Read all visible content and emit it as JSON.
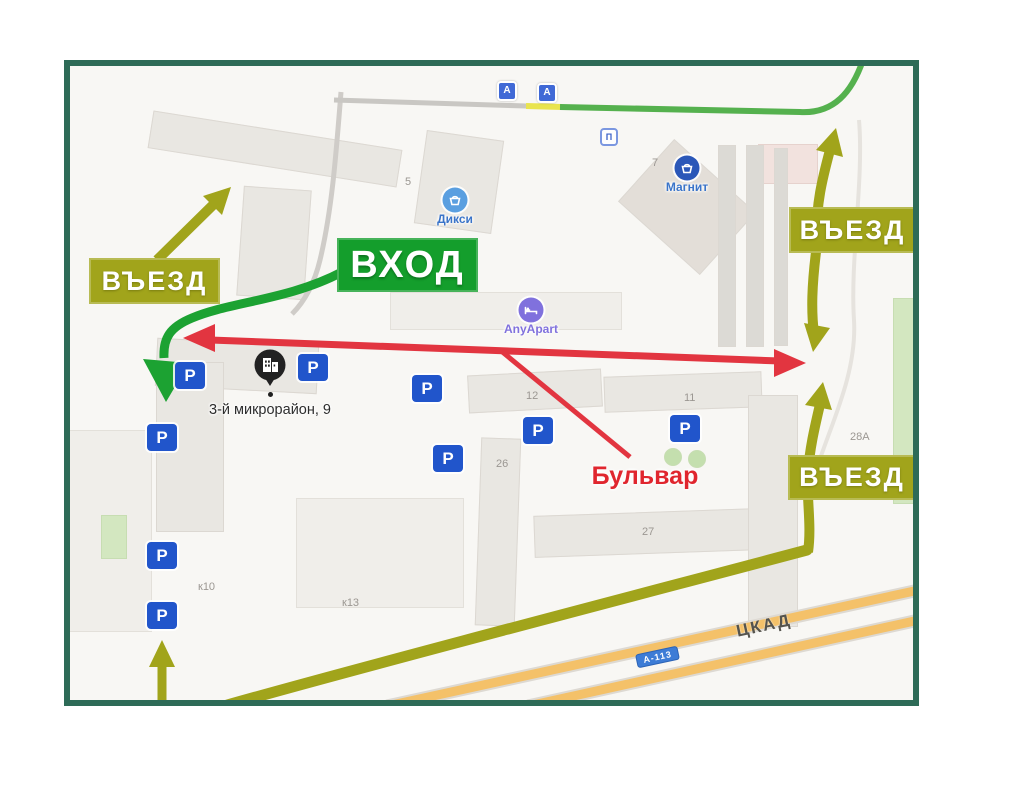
{
  "colors": {
    "frame": "#2e6b57",
    "olive": "#a1a41b",
    "green": "#149e2c",
    "route_green": "#55b14e",
    "red": "#e23540",
    "parking_blue": "#2155cb",
    "highway_orange": "#f4c169",
    "poi_blue": "#3a74c9",
    "map_bg": "#f8f7f4",
    "building": "#e9e7e2"
  },
  "labels": {
    "entrance_drive": "ВЪЕЗД",
    "entrance_walk": "ВХОД",
    "boulevard": "Бульвар",
    "address": "3-й микрорайон, 9",
    "highway_name": "ЦКАД",
    "highway_code": "А-113",
    "parking": "P",
    "bus_stop": "А",
    "transit": "П"
  },
  "pois": [
    {
      "name": "Дикси"
    },
    {
      "name": "Магнит"
    },
    {
      "name": "AnyApart"
    }
  ],
  "building_numbers": [
    "5",
    "7",
    "12",
    "11",
    "26",
    "27",
    "к10",
    "к13",
    "28А"
  ]
}
